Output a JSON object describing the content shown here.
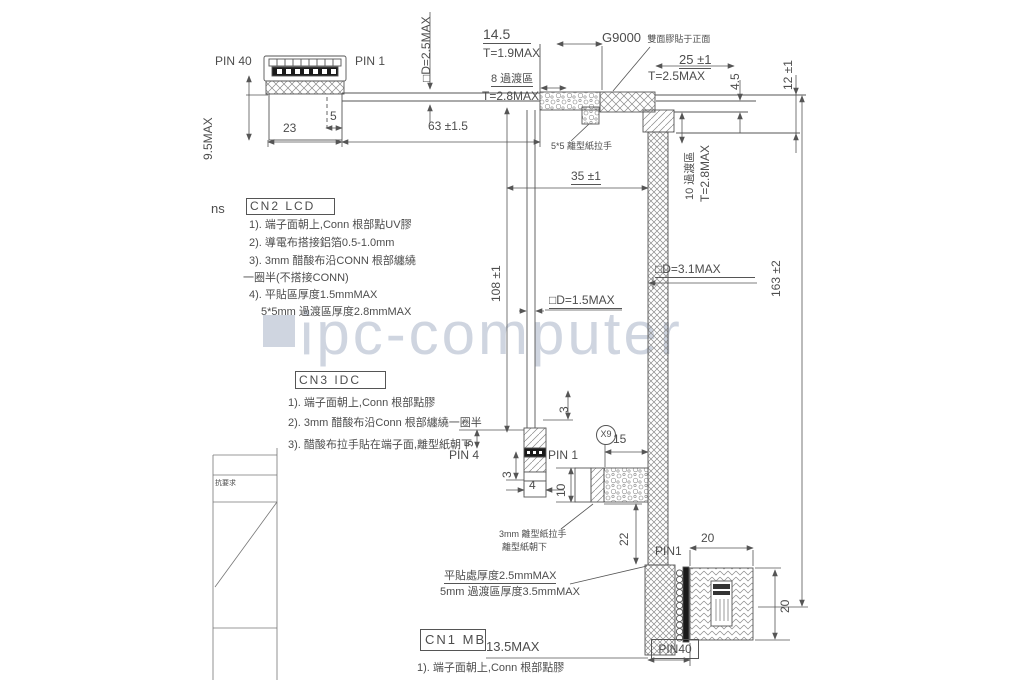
{
  "watermark": {
    "text": "ipc-computer"
  },
  "colors": {
    "line": "#555555",
    "text": "#4d4d4d",
    "watermark": "#cfd5e0",
    "hatch": "#8a8a8a"
  },
  "labels": {
    "pin40_top": "PIN 40",
    "pin1_top": "PIN 1",
    "d_cable": "□D=2.5MAX",
    "w145": "14.5",
    "t19": "T=1.9MAX",
    "zone8": "8 過渡區",
    "t28_top": "T=2.8MAX",
    "g9000_code": "G9000",
    "g9000_desc": "雙面膠貼于正面",
    "w25": "25 ±1",
    "t25": "T=2.5MAX",
    "h45": "4.5",
    "h12": "12 ±1",
    "h95": "9.5MAX",
    "w23": "23",
    "w5": "5",
    "w63": "63 ±1.5",
    "release55": "5*5 離型紙拉手",
    "zone10": "10 過渡區",
    "t28_right": "T=2.8MAX",
    "w35": "35 ±1",
    "h108": "108 ±1",
    "d15": "□D=1.5MAX",
    "d31": "□D=3.1MAX",
    "h163": "163 ±2",
    "pin4": "PIN 4",
    "pin1_mid": "PIN 1",
    "dim3_top": "3",
    "dim5_side": "5",
    "dim3_bot": "3",
    "dim4": "4",
    "x9": "X9",
    "dim15": "15",
    "dim10": "10",
    "dim22": "22",
    "release3_line1": "3mm 離型紙拉手",
    "release3_line2": "離型紙朝下",
    "pin1_bot": "PIN1",
    "dim20_top": "20",
    "dim20_right": "20",
    "flat_thk": "平貼處厚度2.5mmMAX",
    "trans_thk": "5mm 過渡區厚度3.5mmMAX",
    "w135": "13.5MAX",
    "pin40_bot": "PIN40",
    "side_note": "抗要求",
    "ns": "ns"
  },
  "cn2": {
    "title": "CN2 LCD",
    "lines": [
      "1). 端子面朝上,Conn 根部點UV膠",
      "2). 導電布搭接鋁箔0.5-1.0mm",
      "3). 3mm 醋酸布沿CONN 根部纏繞",
      "一圈半(不搭接CONN)",
      "4). 平貼區厚度1.5mmMAX",
      "5*5mm 過渡區厚度2.8mmMAX"
    ]
  },
  "cn3": {
    "title": "CN3 IDC",
    "lines": [
      "1). 端子面朝上,Conn 根部點膠",
      "2). 3mm 醋酸布沿Conn 根部纏繞一圈半",
      "3). 醋酸布拉手貼在端子面,離型紙朝下"
    ]
  },
  "cn1": {
    "title": "CN1 MB",
    "lines": [
      "1). 端子面朝上,Conn 根部點膠"
    ]
  }
}
